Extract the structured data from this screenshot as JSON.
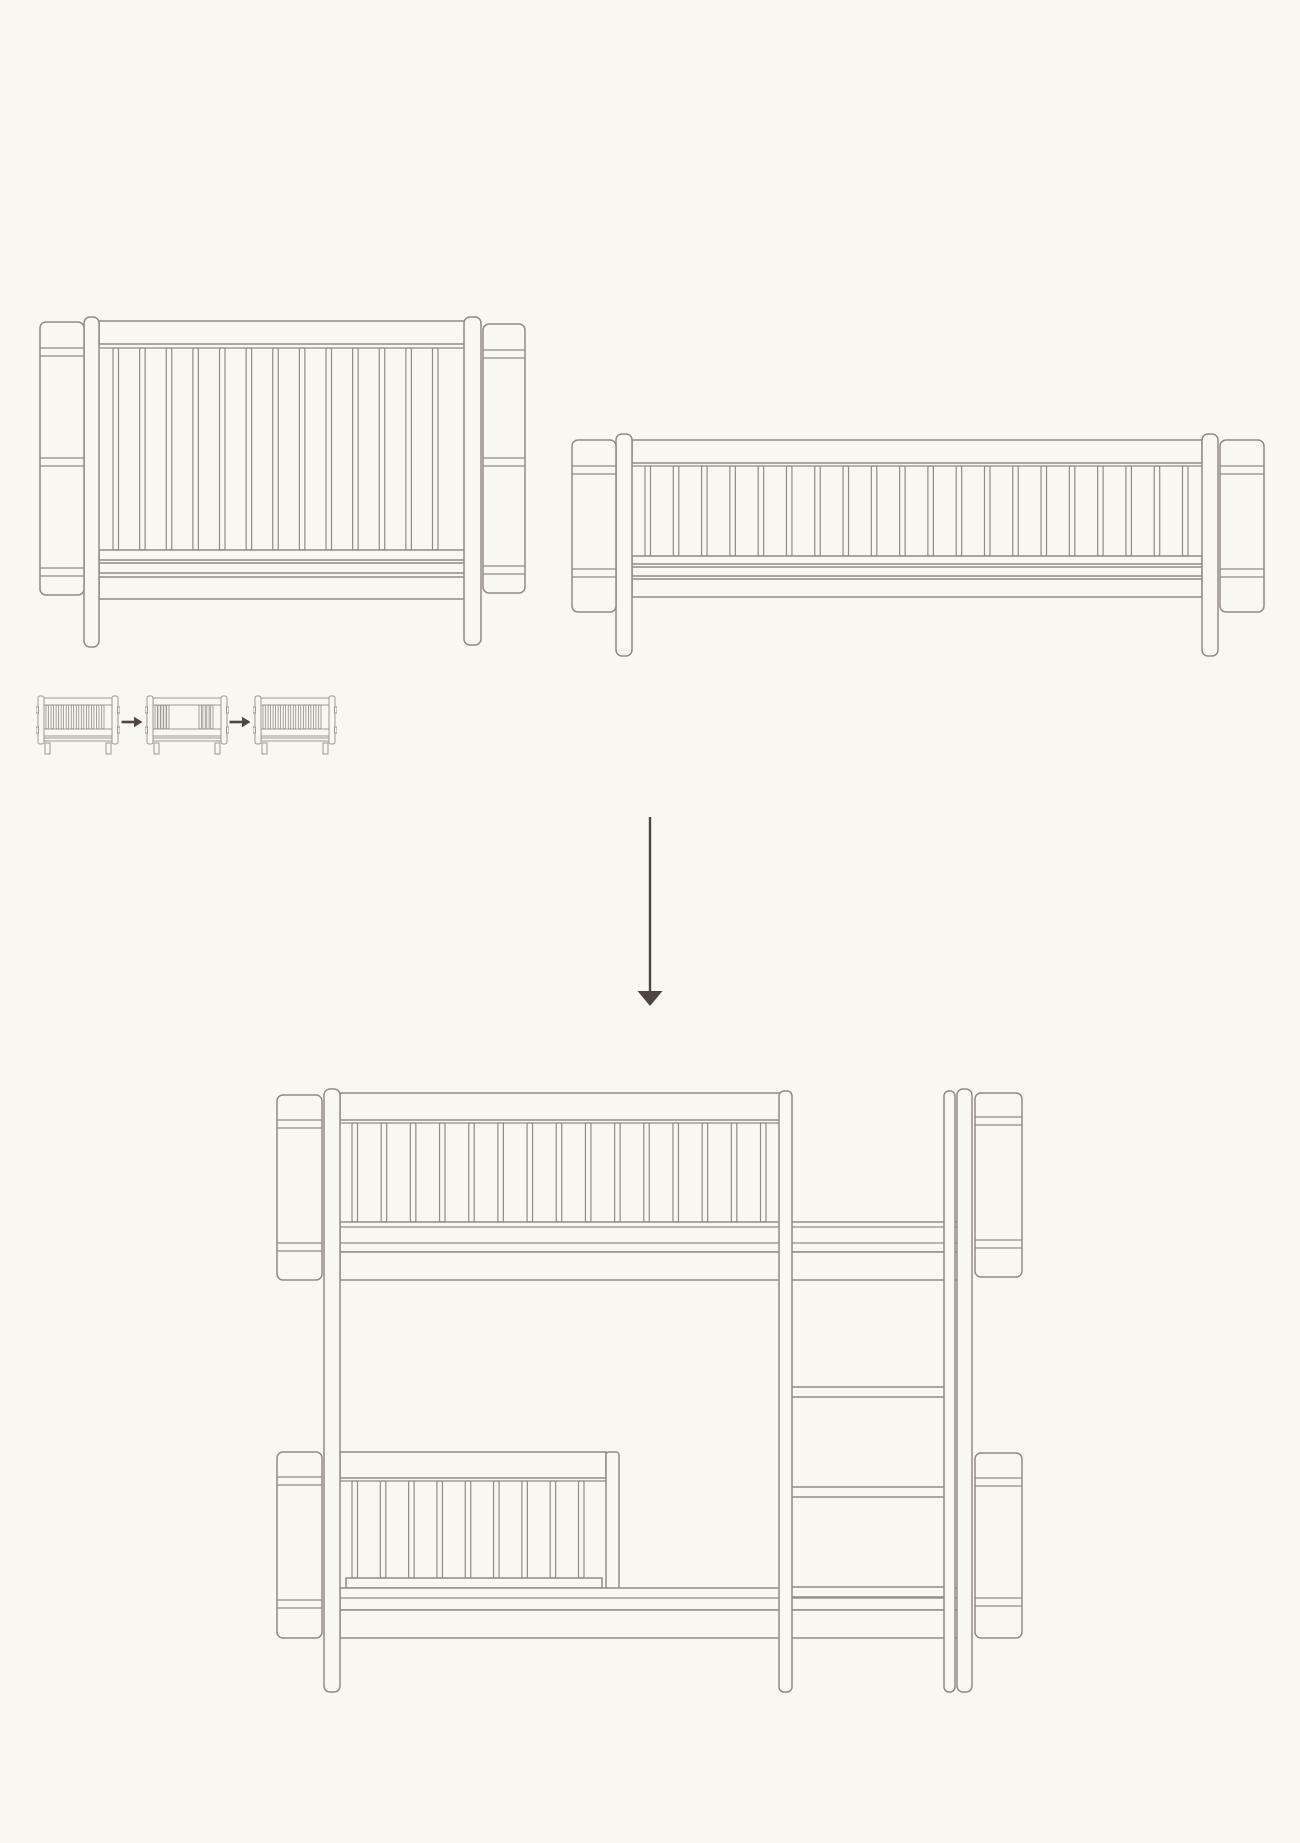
{
  "canvas": {
    "width": 1300,
    "height": 1843,
    "background": "#faf7f0"
  },
  "colors": {
    "line": "#918b84",
    "line_soft": "#9d978f",
    "arrow": "#4e463f"
  },
  "figures": {
    "cot": {
      "name": "cot-bed-side-view",
      "slats": 13
    },
    "junior_bed": {
      "name": "junior-bed-side-view",
      "slats": 20
    },
    "conversion_steps": {
      "step_icons": [
        "cot-bed-icon",
        "cot-bed-open-side-icon",
        "junior-cot-icon"
      ],
      "arrow_icon": "right-arrow-icon",
      "arrow_count": 2
    },
    "down_arrow": {
      "name": "converts-to-down-arrow"
    },
    "bunk_bed": {
      "name": "low-bunk-bed-side-view",
      "upper_slats": 15,
      "lower_slats": 9
    }
  }
}
